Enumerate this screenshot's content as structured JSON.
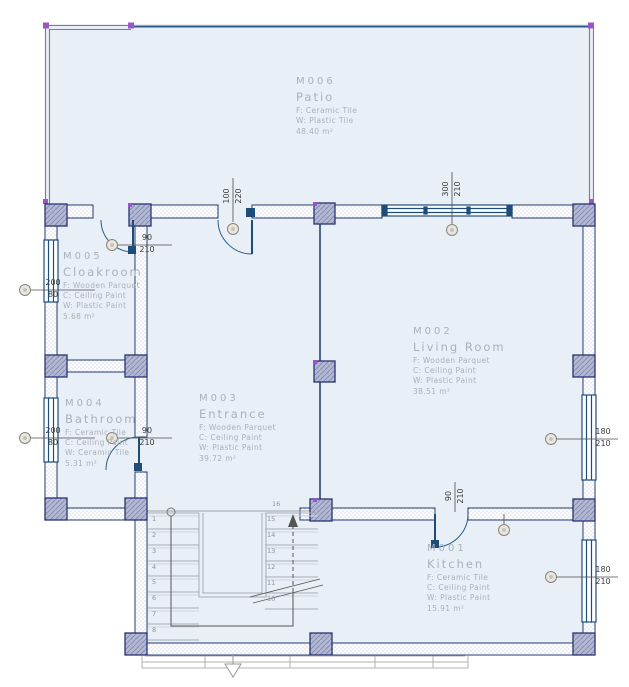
{
  "colors": {
    "room_fill": "#e9eff6",
    "wall_outline": "#1e3a6e",
    "door_window_blue": "#1f4d7a",
    "door_arc_blue": "#2e5c8a",
    "column_fill": "#b3b8d4",
    "marker_purple": "#9a55c8",
    "room_label_text": "#a9b1bd",
    "dimension_text": "#3d3d3d",
    "railing_gray": "#7d7d7d",
    "stairs_gray": "#a8adb8"
  },
  "rooms": [
    {
      "id": "M006",
      "name": "Patio",
      "lines": [
        "F: Ceramic Tile",
        "W: Plastic Tile"
      ],
      "area": "48.40 m²"
    },
    {
      "id": "M005",
      "name": "Cloakroom",
      "lines": [
        "F: Wooden Parquet",
        "C: Ceiling Paint",
        "W: Plastic Paint"
      ],
      "area": "5.68 m²"
    },
    {
      "id": "M004",
      "name": "Bathroom",
      "lines": [
        "F: Ceramic Tile",
        "C: Ceiling Paint",
        "W: Ceramic Tile"
      ],
      "area": "5.31 m²"
    },
    {
      "id": "M003",
      "name": "Entrance",
      "lines": [
        "F: Wooden Parquet",
        "C: Ceiling Paint",
        "W: Plastic Paint"
      ],
      "area": "39.72 m²"
    },
    {
      "id": "M002",
      "name": "Living Room",
      "lines": [
        "F: Wooden Parquet",
        "C: Ceiling Paint",
        "W: Plastic Paint"
      ],
      "area": "38.51 m²"
    },
    {
      "id": "M001",
      "name": "Kitchen",
      "lines": [
        "F: Ceramic Tile",
        "C: Ceiling Paint",
        "W: Plastic Paint"
      ],
      "area": "15.91 m²"
    }
  ],
  "dimensions": {
    "cloakroom_door": {
      "width": "90",
      "height": "210"
    },
    "cloakroom_window": {
      "width": "200",
      "height": "80"
    },
    "bathroom_window": {
      "width": "200",
      "height": "80"
    },
    "bathroom_door": {
      "width": "90",
      "height": "210"
    },
    "entrance_door": {
      "width": "100",
      "height": "220"
    },
    "living_room_top_window": {
      "width": "300",
      "height": "210"
    },
    "kitchen_door": {
      "width": "90",
      "height": "210"
    },
    "living_room_side_window": {
      "width": "180",
      "height": "210"
    },
    "kitchen_side_window": {
      "width": "180",
      "height": "210"
    }
  },
  "stairs": {
    "left_flight_numbers": [
      "1",
      "2",
      "3",
      "4",
      "5",
      "6",
      "7",
      "8"
    ],
    "right_flight_numbers": [
      "15",
      "14",
      "13",
      "12",
      "11",
      "10"
    ],
    "top_step_number": "16"
  }
}
